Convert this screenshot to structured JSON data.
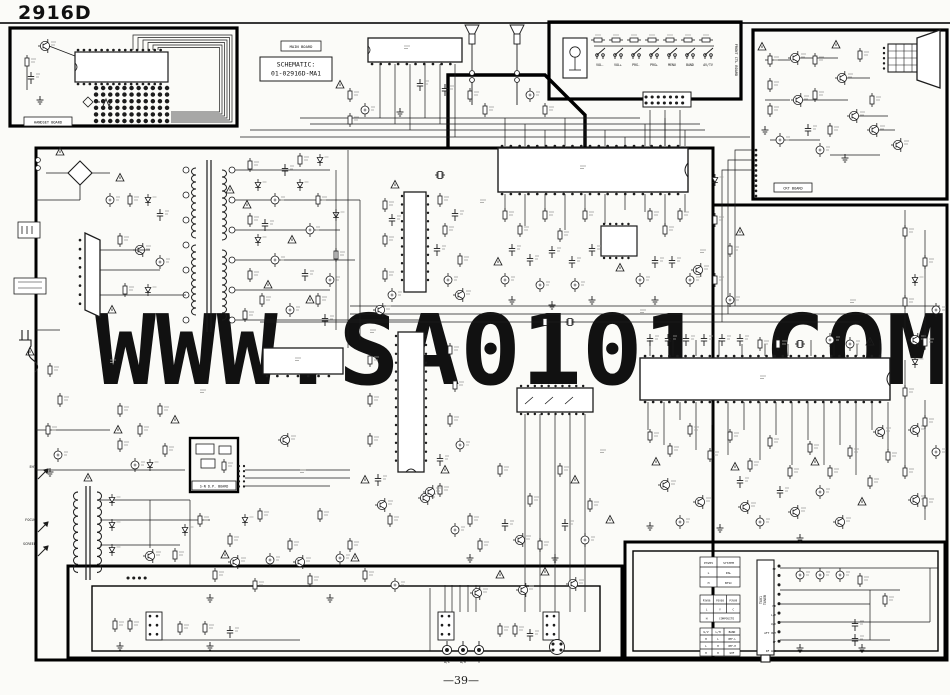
{
  "page": {
    "title": "2916D",
    "page_number": "—39—",
    "watermark": "WWW.SA0101.COM"
  },
  "schematic_box": {
    "line1": "SCHEMATIC:",
    "line2": "01-02916D-MA1"
  },
  "boards": {
    "main": "MAIN BOARD",
    "handset": "HANDSET BOARD",
    "front": "FRONT CTL BOARD",
    "crt": "CRT BOARD",
    "sndp": "S-N D.P. BOARD"
  },
  "front_buttons": [
    "VOL-",
    "VOL+",
    "PRG-",
    "PRG+",
    "MENU",
    "BAND",
    "AV/TV"
  ],
  "fbt_labels": {
    "eht": "EHT",
    "focus": "FOCUS",
    "screen": "SCREEN"
  },
  "jacks": [
    "A/L",
    "A/R",
    "V"
  ],
  "tuner": {
    "name": "TU01",
    "type": "TUNER",
    "pins": [
      "BP",
      "MB",
      "L/H",
      "U/V",
      "AFT OUT",
      "IF",
      "RF AGC"
    ]
  },
  "tables": {
    "system": {
      "headers": [
        "P3V05",
        "SYSTEM"
      ],
      "rows": [
        [
          "L",
          "PAL"
        ],
        [
          "H",
          "NTSC"
        ]
      ]
    },
    "input": {
      "headers": [
        "P3V06",
        "P3V08",
        "P3V09"
      ],
      "rows": [
        [
          "L",
          "Y",
          "C"
        ],
        [
          "H",
          "COMPOSITE"
        ]
      ]
    },
    "band": {
      "headers": [
        "U/V",
        "L/H",
        "BAND"
      ],
      "rows": [
        [
          "H",
          "L",
          "VHF-L"
        ],
        [
          "L",
          "H",
          "VHF-H"
        ],
        [
          "H",
          "H",
          "UHF"
        ]
      ]
    }
  },
  "colors": {
    "line": "#1c1c1c",
    "watermark": "#b8bee3",
    "paper": "#fbfbf8"
  }
}
